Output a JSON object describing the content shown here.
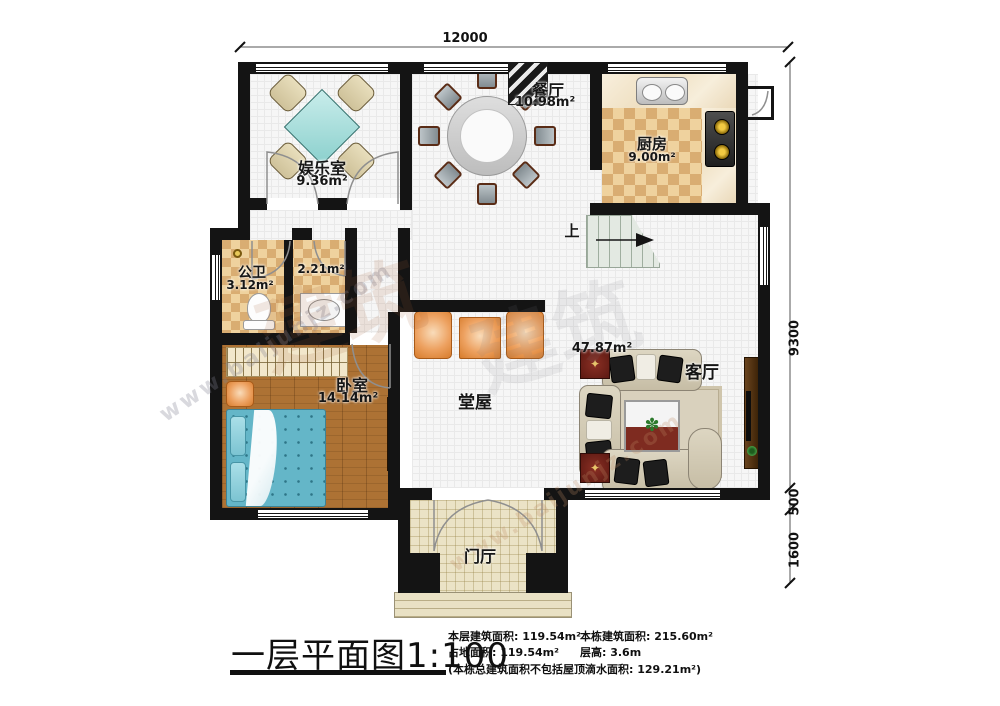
{
  "plan": {
    "dims": {
      "top": "12000",
      "right_main": "9300",
      "right_step": "500",
      "right_porch": "1600"
    },
    "rooms": {
      "entertainment": {
        "name": "娱乐室",
        "area": "9.36m²"
      },
      "dining": {
        "name": "餐厅",
        "area": "10.98m²"
      },
      "kitchen": {
        "name": "厨房",
        "area": "9.00m²"
      },
      "bathroom": {
        "name": "公卫",
        "area": "3.12m²"
      },
      "washroom": {
        "area": "2.21m²"
      },
      "bedroom": {
        "name": "卧室",
        "area": "14.14m²"
      },
      "hall": {
        "name": "堂屋"
      },
      "living": {
        "name": "客厅",
        "area": "47.87m²"
      },
      "foyer": {
        "name": "门厅"
      },
      "stairs": {
        "label": "上"
      }
    }
  },
  "titleblock": {
    "title": "一层平面图",
    "scale": "1:100",
    "floor_area": "本层建筑面积: 119.54m²",
    "land_area": "占地面积: 119.54m²",
    "total_area": "本栋建筑面积: 215.60m²",
    "floor_height": "层高: 3.6m",
    "note": "(本栋总建筑面积不包括屋顶滴水面积: 129.21m²)"
  },
  "watermark": {
    "site": "www.baijunjz.com",
    "glyphs": "建筑"
  }
}
